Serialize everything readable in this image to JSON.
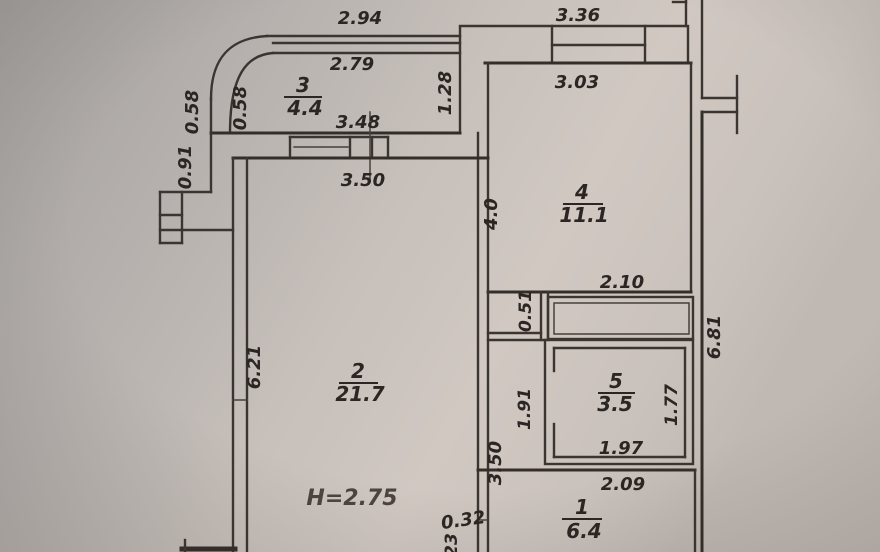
{
  "plan": {
    "type_note": "apartment floor plan photo",
    "height_note": "H=2.75",
    "ink_color": "#3a3530",
    "paper_colors": [
      "#a3a09e",
      "#c6bfba",
      "#d0c8c1"
    ],
    "rooms": [
      {
        "number": "1",
        "area": "6.4"
      },
      {
        "number": "2",
        "area": "21.7"
      },
      {
        "number": "3",
        "area": "4.4"
      },
      {
        "number": "4",
        "area": "11.1"
      },
      {
        "number": "5",
        "area": "3.5"
      }
    ],
    "dims": {
      "w294": "2.94",
      "w336": "3.36",
      "w279": "2.79",
      "w348": "3.48",
      "w350top": "3.50",
      "h128": "1.28",
      "h058a": "0.58",
      "h058b": "0.58",
      "h091": "0.91",
      "h621": "6.21",
      "w303": "3.03",
      "h40": "4.0",
      "h681": "6.81",
      "w210": "2.10",
      "h051": "0.51",
      "h191": "1.91",
      "h177": "1.77",
      "w197": "1.97",
      "w209": "2.09",
      "h350left": "3.50",
      "w032": "0.32",
      "partial23": "23"
    }
  }
}
